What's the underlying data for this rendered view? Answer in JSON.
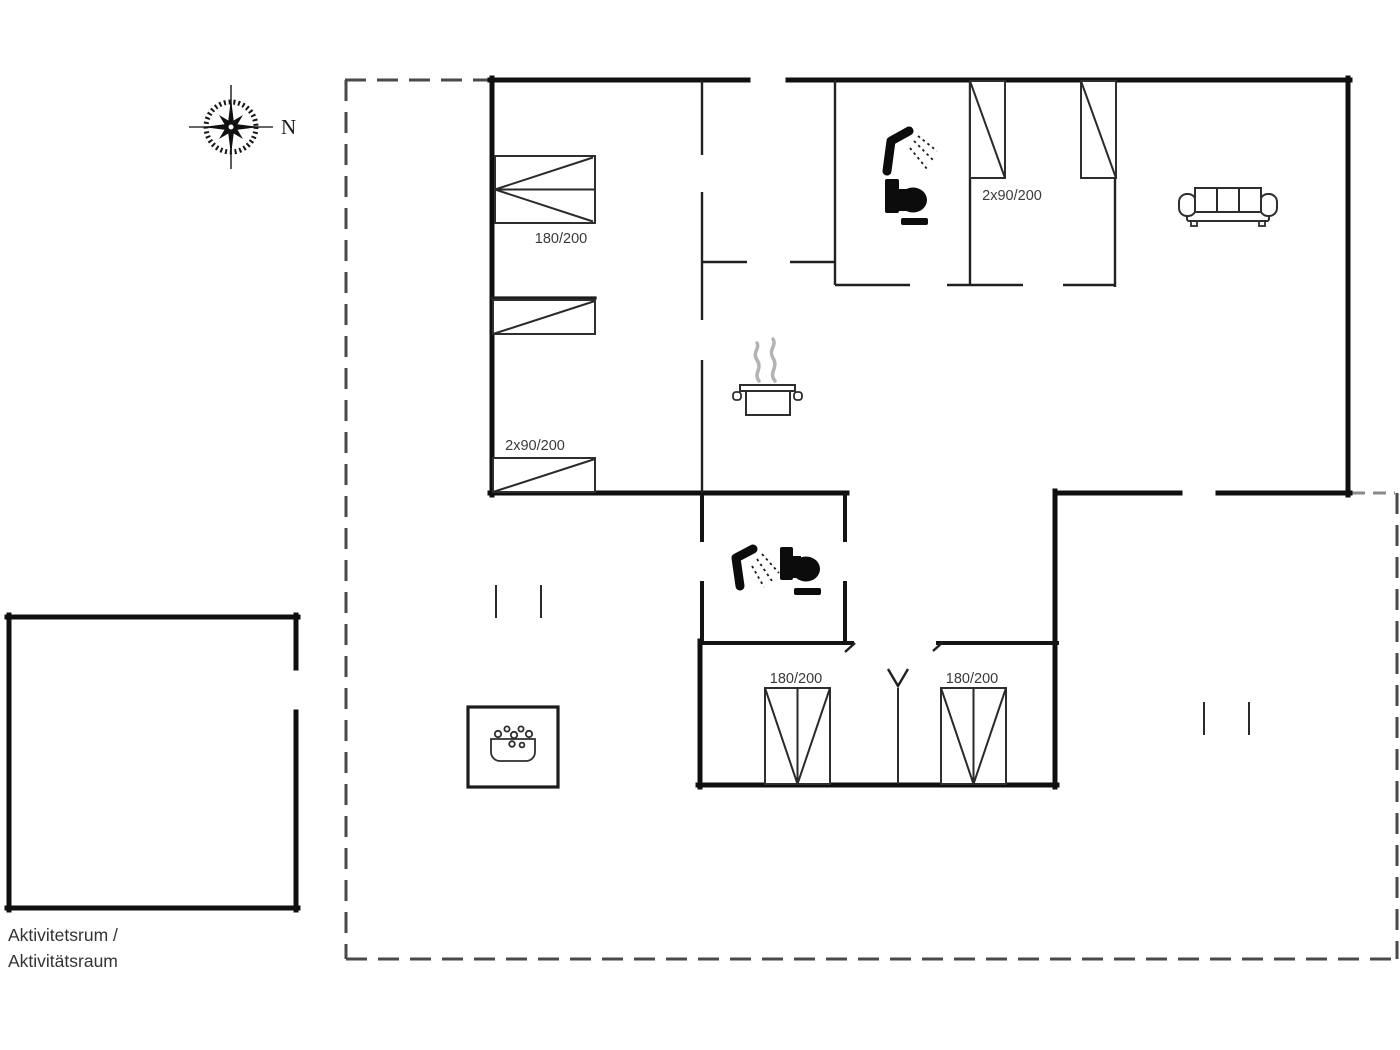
{
  "plan_type": "holiday-house-floor-plan",
  "compass": {
    "north_label": "N"
  },
  "labels": {
    "bed_double_top_left": "180/200",
    "bedroom_singles_left": "2x90/200",
    "bedroom_singles_top": "2x90/200",
    "bed_double_bottom_left": "180/200",
    "bed_double_bottom_right": "180/200"
  },
  "annex": {
    "line1": "Aktivitetsrum /",
    "line2": "Aktivitätsraum"
  },
  "icons": [
    "compass-rose-icon",
    "shower-icon",
    "toilet-icon",
    "cooking-pot-icon",
    "sofa-icon",
    "hot-tub-icon",
    "door-swing-icon"
  ],
  "colors": {
    "wall": "#0f0f0f",
    "interior_wall": "#202020",
    "furniture": "#2e2e2e",
    "plot_boundary": "#4a4a4a",
    "steam": "#b3b3b3",
    "text": "#3a3a3a",
    "background": "#ffffff"
  }
}
